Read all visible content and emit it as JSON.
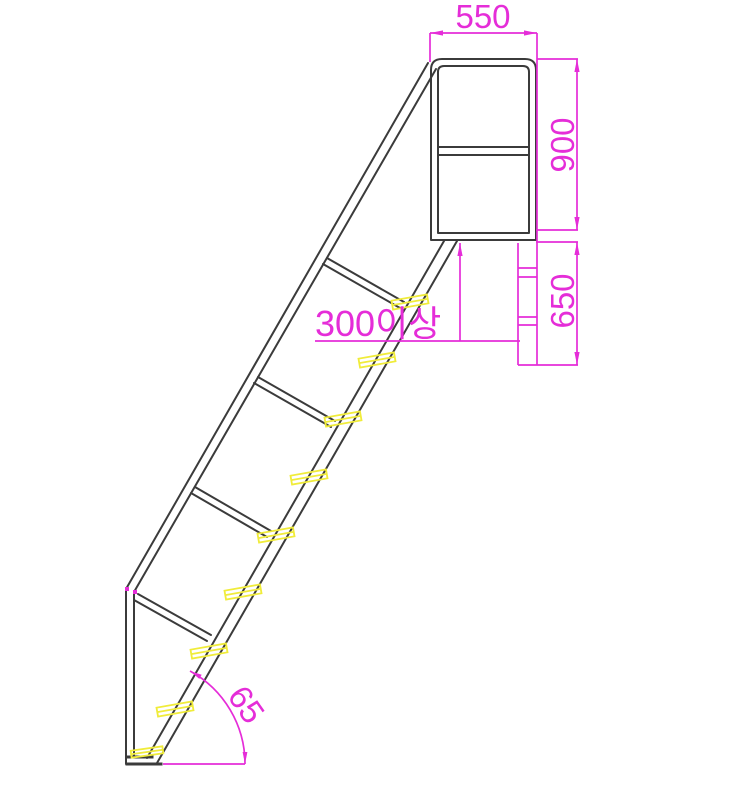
{
  "drawing": {
    "type": "cad-elevation-ladder-with-handrail",
    "labels": {
      "top_width": "550",
      "upper_height": "900",
      "lower_height": "650",
      "min_clearance": "300이상",
      "angle_deg": "65"
    },
    "colors": {
      "dimension_magenta": "#e52dd8",
      "structure_line": "#3b3b3b",
      "tread_yellow": "#f0ec3a",
      "background": "#ffffff"
    },
    "counts": {
      "rungs": 4,
      "tread_marks": 9
    }
  }
}
